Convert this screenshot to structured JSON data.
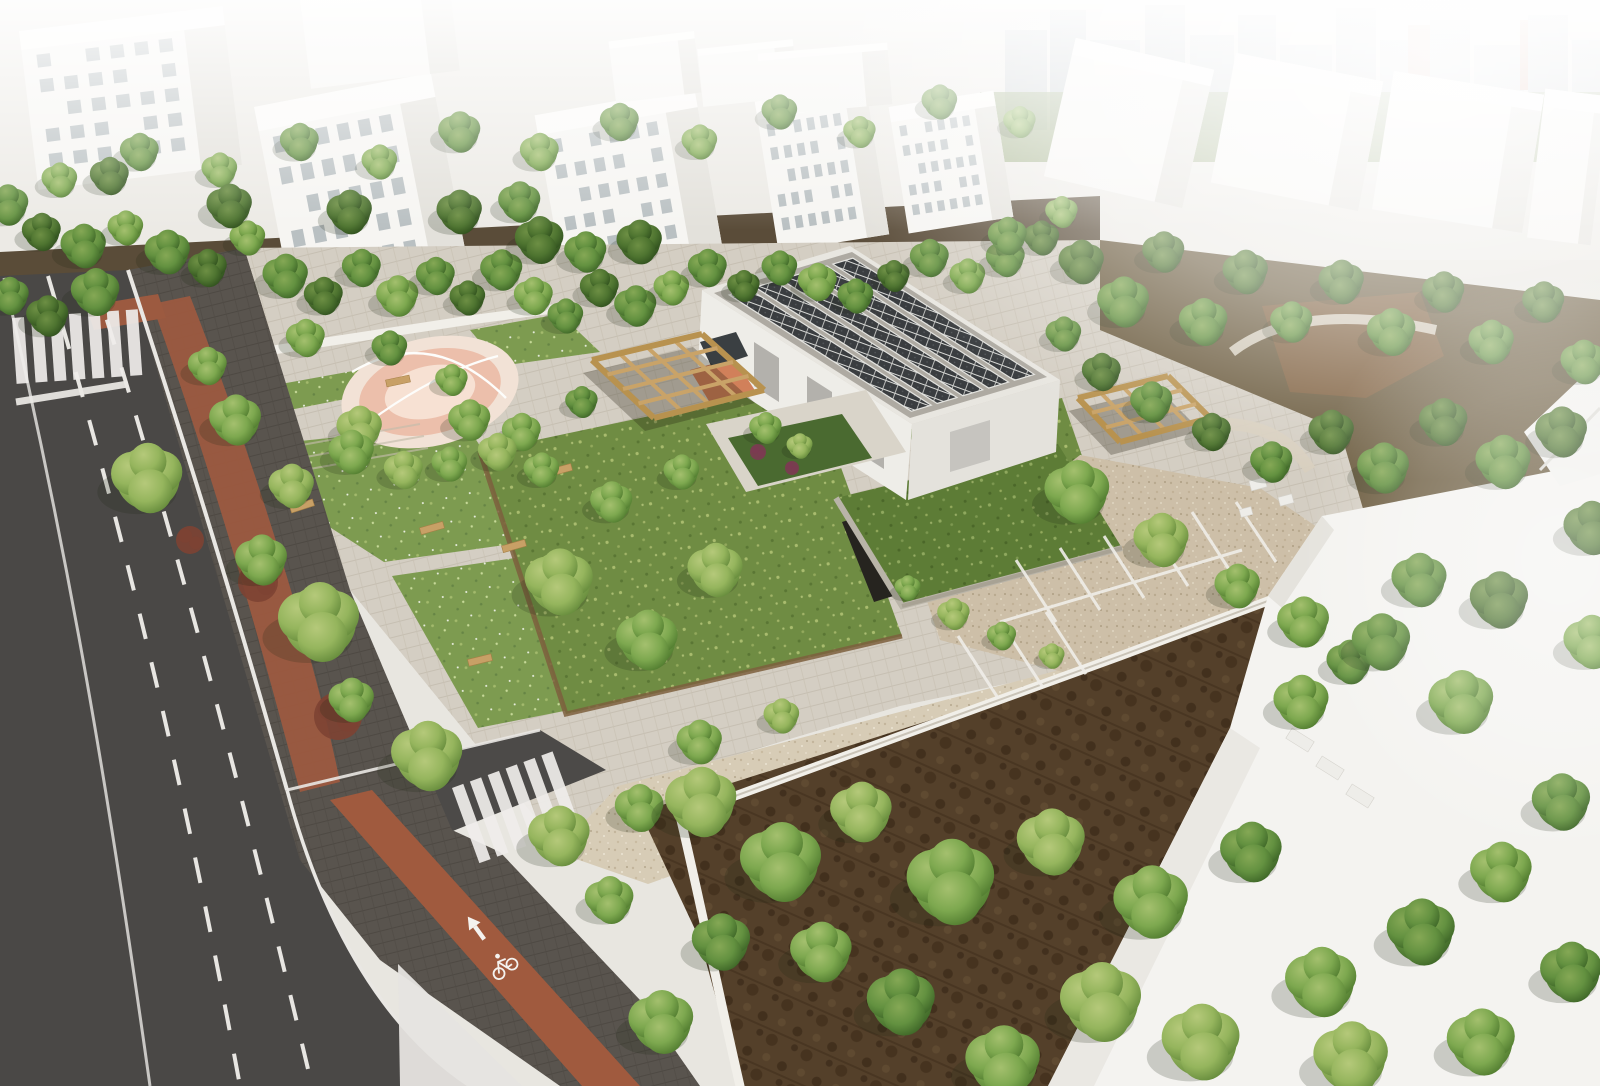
{
  "scene": {
    "title": "aerial-architectural-rendering",
    "type": "3d-site-visualization-of-park-and-community-building",
    "camera": "oblique-birds-eye"
  },
  "palette": {
    "asphalt": "#4a4846",
    "sidewalk_pavers": "#59544e",
    "bike_lane": "#9c5a40",
    "road_marking": "#efedea",
    "plaza_pavers": "#d4cec3",
    "gravel_path": "#d7ccb6",
    "parking_gravel": "#cdbfa8",
    "lawn": "#7d9b50",
    "meadow": "#6f8c43",
    "green_roof": "#5d7c36",
    "woodland_floor": "#54402a",
    "undergrowth": "#4a3b26",
    "building_white": "#f2f1ed",
    "building_shade": "#e1dfd8",
    "roof_gray": "#aeaaa2",
    "solar_panel": "#3a3d40",
    "solar_frame": "#d9dad7",
    "pergola_wood": "#c9a368",
    "playground_pink": "#ecbfab",
    "playground_pale": "#f7e1d3",
    "wall_white": "#f1efe9",
    "shrub_red": "#7d4233",
    "shrub_purple": "#7c3b52",
    "bench_wood": "#c8a066",
    "haze": "#ffffff"
  },
  "road": {
    "crosswalk": {
      "x": 12,
      "y": 318,
      "rot": -4,
      "n": 7,
      "step": 19,
      "w": 12,
      "h": 66
    },
    "zebra": {
      "x": 452,
      "y": 788,
      "rot": -20,
      "n": 6,
      "step": 19,
      "w": 12,
      "h": 80
    },
    "dash_pattern": "26 24",
    "arrow": {
      "x": 476,
      "y": 928,
      "rot": -36,
      "meaning": "straight-ahead"
    },
    "bike_symbol": {
      "x": 502,
      "y": 964,
      "rot": -36,
      "meaning": "bicycle-lane"
    },
    "island": [
      [
        398,
        964
      ],
      [
        522,
        1086
      ],
      [
        400,
        1086
      ]
    ]
  },
  "main_building": {
    "roof_outer": [
      [
        702,
        290
      ],
      [
        850,
        246
      ],
      [
        1060,
        380
      ],
      [
        912,
        424
      ]
    ],
    "roof_inner": [
      [
        714,
        293
      ],
      [
        852,
        252
      ],
      [
        1047,
        377
      ],
      [
        910,
        418
      ]
    ],
    "solar_rows": 5,
    "doors_front": [
      [
        754,
        342
      ],
      [
        807,
        376
      ],
      [
        859,
        409
      ]
    ],
    "entrance_color": "#cf7a52"
  },
  "pergolas": [
    {
      "corners": [
        [
          592,
          360
        ],
        [
          702,
          334
        ],
        [
          764,
          390
        ],
        [
          654,
          418
        ]
      ],
      "nx": 4,
      "ny": 4
    },
    {
      "corners": [
        [
          1078,
          398
        ],
        [
          1168,
          376
        ],
        [
          1210,
          418
        ],
        [
          1120,
          442
        ]
      ],
      "nx": 4,
      "ny": 3
    }
  ],
  "playground": {
    "cx": 430,
    "cy": 392,
    "rot": -13,
    "rings": [
      [
        90,
        54,
        "#f2e2d6"
      ],
      [
        72,
        42,
        "#ecbfab"
      ],
      [
        46,
        26,
        "#f7e1d3"
      ]
    ]
  },
  "parking_stripes": [
    [
      1016,
      560,
      1056,
      622
    ],
    [
      1060,
      548,
      1100,
      610
    ],
    [
      1104,
      536,
      1144,
      598
    ],
    [
      1148,
      524,
      1188,
      586
    ],
    [
      1192,
      512,
      1232,
      574
    ],
    [
      1236,
      502,
      1276,
      562
    ],
    [
      1000,
      622,
      1242,
      550
    ],
    [
      958,
      636,
      998,
      698
    ],
    [
      1002,
      624,
      1042,
      686
    ],
    [
      1046,
      612,
      1086,
      674
    ]
  ],
  "top_buildings": [
    {
      "x": 28,
      "y": 18,
      "w": 205,
      "h": 160,
      "rot": -7,
      "win": true
    },
    {
      "x": 272,
      "y": 88,
      "w": 180,
      "h": 205,
      "rot": -11,
      "win": true
    },
    {
      "x": 305,
      "y": -10,
      "w": 150,
      "h": 90,
      "rot": -7,
      "win": false
    },
    {
      "x": 548,
      "y": 100,
      "w": 162,
      "h": 168,
      "rot": -10,
      "win": true
    },
    {
      "x": 612,
      "y": 36,
      "w": 86,
      "h": 62,
      "rot": -7,
      "win": false
    },
    {
      "x": 700,
      "y": 44,
      "w": 96,
      "h": 58,
      "rot": -6,
      "win": false
    },
    {
      "x": 766,
      "y": 92,
      "w": 112,
      "h": 152,
      "rot": -9,
      "win": true
    },
    {
      "x": 898,
      "y": 98,
      "w": 106,
      "h": 128,
      "rot": -9,
      "win": true
    },
    {
      "x": 760,
      "y": 48,
      "w": 130,
      "h": 62,
      "rot": -5,
      "win": false
    },
    {
      "x": 1058,
      "y": 52,
      "w": 142,
      "h": 142,
      "rot": 13,
      "win": false
    },
    {
      "x": 1222,
      "y": 66,
      "w": 150,
      "h": 132,
      "rot": 11,
      "win": false
    },
    {
      "x": 1382,
      "y": 82,
      "w": 152,
      "h": 140,
      "rot": 9,
      "win": false
    },
    {
      "x": 1536,
      "y": 92,
      "w": 64,
      "h": 150,
      "rot": 7,
      "win": false
    }
  ],
  "city_blocks": [
    [
      1005,
      30,
      42,
      100,
      "#c8cdd0"
    ],
    [
      1050,
      10,
      36,
      120,
      "#bfc6ca"
    ],
    [
      1090,
      40,
      50,
      90,
      "#ccd1d3"
    ],
    [
      1145,
      5,
      40,
      125,
      "#c2c8cb"
    ],
    [
      1190,
      35,
      44,
      95,
      "#cdd2d4"
    ],
    [
      1238,
      15,
      38,
      115,
      "#c6cbce"
    ],
    [
      1280,
      45,
      52,
      85,
      "#d0d4d6"
    ],
    [
      1336,
      8,
      40,
      120,
      "#c3c9cc"
    ],
    [
      1380,
      40,
      46,
      90,
      "#ced2d4"
    ],
    [
      1408,
      25,
      26,
      60,
      "#d4a794"
    ],
    [
      1430,
      20,
      40,
      110,
      "#c7cccf"
    ],
    [
      1474,
      45,
      50,
      85,
      "#d1d5d7"
    ],
    [
      1520,
      20,
      30,
      70,
      "#cfa08e"
    ],
    [
      1528,
      15,
      40,
      115,
      "#c5cacd"
    ],
    [
      1572,
      40,
      28,
      90,
      "#cfd3d5"
    ]
  ],
  "trees": [
    [
      8,
      205,
      26,
      1
    ],
    [
      42,
      232,
      24,
      0
    ],
    [
      84,
      246,
      28,
      1
    ],
    [
      126,
      228,
      22,
      2
    ],
    [
      168,
      252,
      28,
      1
    ],
    [
      208,
      268,
      24,
      0
    ],
    [
      248,
      238,
      22,
      2
    ],
    [
      286,
      276,
      28,
      1
    ],
    [
      324,
      296,
      24,
      0
    ],
    [
      362,
      268,
      24,
      1
    ],
    [
      398,
      296,
      26,
      2
    ],
    [
      436,
      276,
      24,
      1
    ],
    [
      468,
      298,
      22,
      0
    ],
    [
      502,
      270,
      26,
      1
    ],
    [
      534,
      296,
      24,
      2
    ],
    [
      566,
      316,
      22,
      1
    ],
    [
      600,
      288,
      24,
      0
    ],
    [
      636,
      306,
      26,
      1
    ],
    [
      672,
      288,
      22,
      2
    ],
    [
      708,
      268,
      24,
      1
    ],
    [
      744,
      286,
      20,
      0
    ],
    [
      780,
      268,
      22,
      1
    ],
    [
      818,
      282,
      24,
      2
    ],
    [
      856,
      296,
      22,
      1
    ],
    [
      894,
      276,
      20,
      0
    ],
    [
      930,
      258,
      24,
      1
    ],
    [
      968,
      276,
      22,
      2
    ],
    [
      1006,
      258,
      24,
      1
    ],
    [
      1042,
      238,
      22,
      0
    ],
    [
      60,
      180,
      22,
      2
    ],
    [
      140,
      152,
      24,
      1
    ],
    [
      220,
      170,
      22,
      2
    ],
    [
      300,
      142,
      24,
      1
    ],
    [
      380,
      162,
      22,
      2
    ],
    [
      460,
      132,
      26,
      1
    ],
    [
      540,
      152,
      24,
      2
    ],
    [
      620,
      122,
      24,
      1
    ],
    [
      700,
      142,
      22,
      2
    ],
    [
      780,
      112,
      22,
      1
    ],
    [
      860,
      132,
      20,
      2
    ],
    [
      940,
      102,
      22,
      1
    ],
    [
      1020,
      122,
      20,
      2
    ],
    [
      96,
      292,
      30,
      1
    ],
    [
      48,
      316,
      26,
      0
    ],
    [
      10,
      296,
      24,
      1
    ],
    [
      540,
      240,
      30,
      0
    ],
    [
      586,
      252,
      26,
      1
    ],
    [
      640,
      242,
      28,
      0
    ],
    [
      520,
      202,
      26,
      1
    ],
    [
      460,
      212,
      28,
      0
    ],
    [
      350,
      212,
      28,
      0
    ],
    [
      230,
      206,
      28,
      0
    ],
    [
      110,
      176,
      24,
      0
    ],
    [
      1082,
      262,
      28,
      0
    ],
    [
      1124,
      302,
      32,
      1
    ],
    [
      1164,
      252,
      26,
      0
    ],
    [
      1204,
      322,
      30,
      1
    ],
    [
      1246,
      272,
      28,
      0
    ],
    [
      1292,
      322,
      26,
      1
    ],
    [
      1342,
      282,
      28,
      0
    ],
    [
      1392,
      332,
      30,
      1
    ],
    [
      1444,
      292,
      26,
      0
    ],
    [
      1492,
      342,
      28,
      1
    ],
    [
      1544,
      302,
      26,
      0
    ],
    [
      1584,
      362,
      28,
      1
    ],
    [
      1562,
      432,
      32,
      0
    ],
    [
      1504,
      462,
      34,
      1
    ],
    [
      1444,
      422,
      30,
      0
    ],
    [
      1384,
      468,
      32,
      1
    ],
    [
      1332,
      432,
      28,
      0
    ],
    [
      1272,
      462,
      26,
      1
    ],
    [
      1212,
      432,
      24,
      0
    ],
    [
      1152,
      402,
      26,
      1
    ],
    [
      1102,
      372,
      24,
      0
    ],
    [
      1064,
      334,
      22,
      1
    ],
    [
      1420,
      580,
      34,
      1
    ],
    [
      1500,
      600,
      36,
      0
    ],
    [
      1592,
      528,
      34,
      0
    ],
    [
      148,
      478,
      44,
      3
    ],
    [
      236,
      420,
      32,
      2
    ],
    [
      208,
      366,
      24,
      2
    ],
    [
      292,
      486,
      28,
      3
    ],
    [
      320,
      622,
      50,
      3
    ],
    [
      262,
      560,
      32,
      2
    ],
    [
      428,
      756,
      44,
      3
    ],
    [
      352,
      700,
      28,
      2
    ],
    [
      560,
      836,
      38,
      3
    ],
    [
      640,
      808,
      30,
      2
    ],
    [
      470,
      420,
      26,
      2
    ],
    [
      360,
      428,
      28,
      3
    ],
    [
      306,
      338,
      24,
      2
    ],
    [
      390,
      348,
      22,
      1
    ],
    [
      452,
      380,
      20,
      2
    ],
    [
      522,
      432,
      24,
      2
    ],
    [
      582,
      402,
      20,
      1
    ],
    [
      352,
      452,
      28,
      2
    ],
    [
      404,
      470,
      24,
      3
    ],
    [
      450,
      464,
      22,
      2
    ],
    [
      498,
      452,
      24,
      3
    ],
    [
      542,
      470,
      22,
      2
    ],
    [
      560,
      582,
      42,
      3
    ],
    [
      648,
      640,
      38,
      2
    ],
    [
      716,
      570,
      34,
      3
    ],
    [
      612,
      502,
      26,
      2
    ],
    [
      682,
      472,
      22,
      2
    ],
    [
      766,
      428,
      20,
      2
    ],
    [
      800,
      446,
      16,
      3
    ],
    [
      1008,
      236,
      24,
      1
    ],
    [
      1062,
      212,
      20,
      2
    ],
    [
      700,
      742,
      28,
      2
    ],
    [
      782,
      716,
      22,
      3
    ],
    [
      1078,
      492,
      40,
      2
    ],
    [
      1162,
      540,
      34,
      3
    ],
    [
      1238,
      586,
      28,
      2
    ],
    [
      954,
      614,
      20,
      3
    ],
    [
      1002,
      636,
      18,
      2
    ],
    [
      1052,
      656,
      16,
      3
    ],
    [
      908,
      588,
      16,
      2
    ],
    [
      1304,
      622,
      32,
      2
    ],
    [
      1350,
      662,
      28,
      1
    ],
    [
      702,
      802,
      44,
      3
    ],
    [
      782,
      862,
      50,
      2
    ],
    [
      862,
      812,
      38,
      3
    ],
    [
      952,
      882,
      54,
      2
    ],
    [
      1052,
      842,
      42,
      3
    ],
    [
      1152,
      902,
      46,
      2
    ],
    [
      1252,
      852,
      38,
      1
    ],
    [
      1102,
      1002,
      50,
      3
    ],
    [
      1004,
      1062,
      46,
      2
    ],
    [
      902,
      1002,
      42,
      1
    ],
    [
      822,
      952,
      38,
      2
    ],
    [
      722,
      942,
      36,
      1
    ],
    [
      662,
      1022,
      40,
      2
    ],
    [
      1202,
      1042,
      48,
      3
    ],
    [
      1322,
      982,
      44,
      2
    ],
    [
      1422,
      932,
      42,
      1
    ],
    [
      1502,
      872,
      38,
      2
    ],
    [
      1562,
      802,
      36,
      1
    ],
    [
      1462,
      702,
      40,
      2
    ],
    [
      1382,
      642,
      36,
      1
    ],
    [
      1302,
      702,
      34,
      2
    ],
    [
      1352,
      1058,
      46,
      3
    ],
    [
      1482,
      1042,
      42,
      2
    ],
    [
      1572,
      972,
      38,
      1
    ],
    [
      1592,
      642,
      34,
      2
    ],
    [
      610,
      900,
      30,
      2
    ]
  ],
  "benches": [
    [
      432,
      528,
      -16
    ],
    [
      514,
      546,
      -16
    ],
    [
      480,
      660,
      -14
    ],
    [
      398,
      381,
      -12
    ],
    [
      302,
      506,
      -18
    ],
    [
      560,
      470,
      -15
    ]
  ],
  "shrubs": [
    {
      "x": 258,
      "y": 582,
      "r": 20,
      "c": "#7d4233"
    },
    {
      "x": 338,
      "y": 716,
      "r": 24,
      "c": "#7d4233"
    },
    {
      "x": 190,
      "y": 540,
      "r": 14,
      "c": "#7d4233"
    },
    {
      "x": 758,
      "y": 452,
      "r": 8,
      "c": "#7c3b52"
    },
    {
      "x": 792,
      "y": 468,
      "r": 7,
      "c": "#7c3b52"
    }
  ],
  "white_boxes": [
    [
      1258,
      484,
      16,
      10,
      -15
    ],
    [
      1286,
      500,
      14,
      9,
      -15
    ],
    [
      1246,
      512,
      12,
      8,
      -15
    ],
    [
      1300,
      740,
      12,
      26,
      -58
    ],
    [
      1330,
      768,
      12,
      26,
      -58
    ],
    [
      1360,
      796,
      12,
      26,
      -58
    ]
  ]
}
